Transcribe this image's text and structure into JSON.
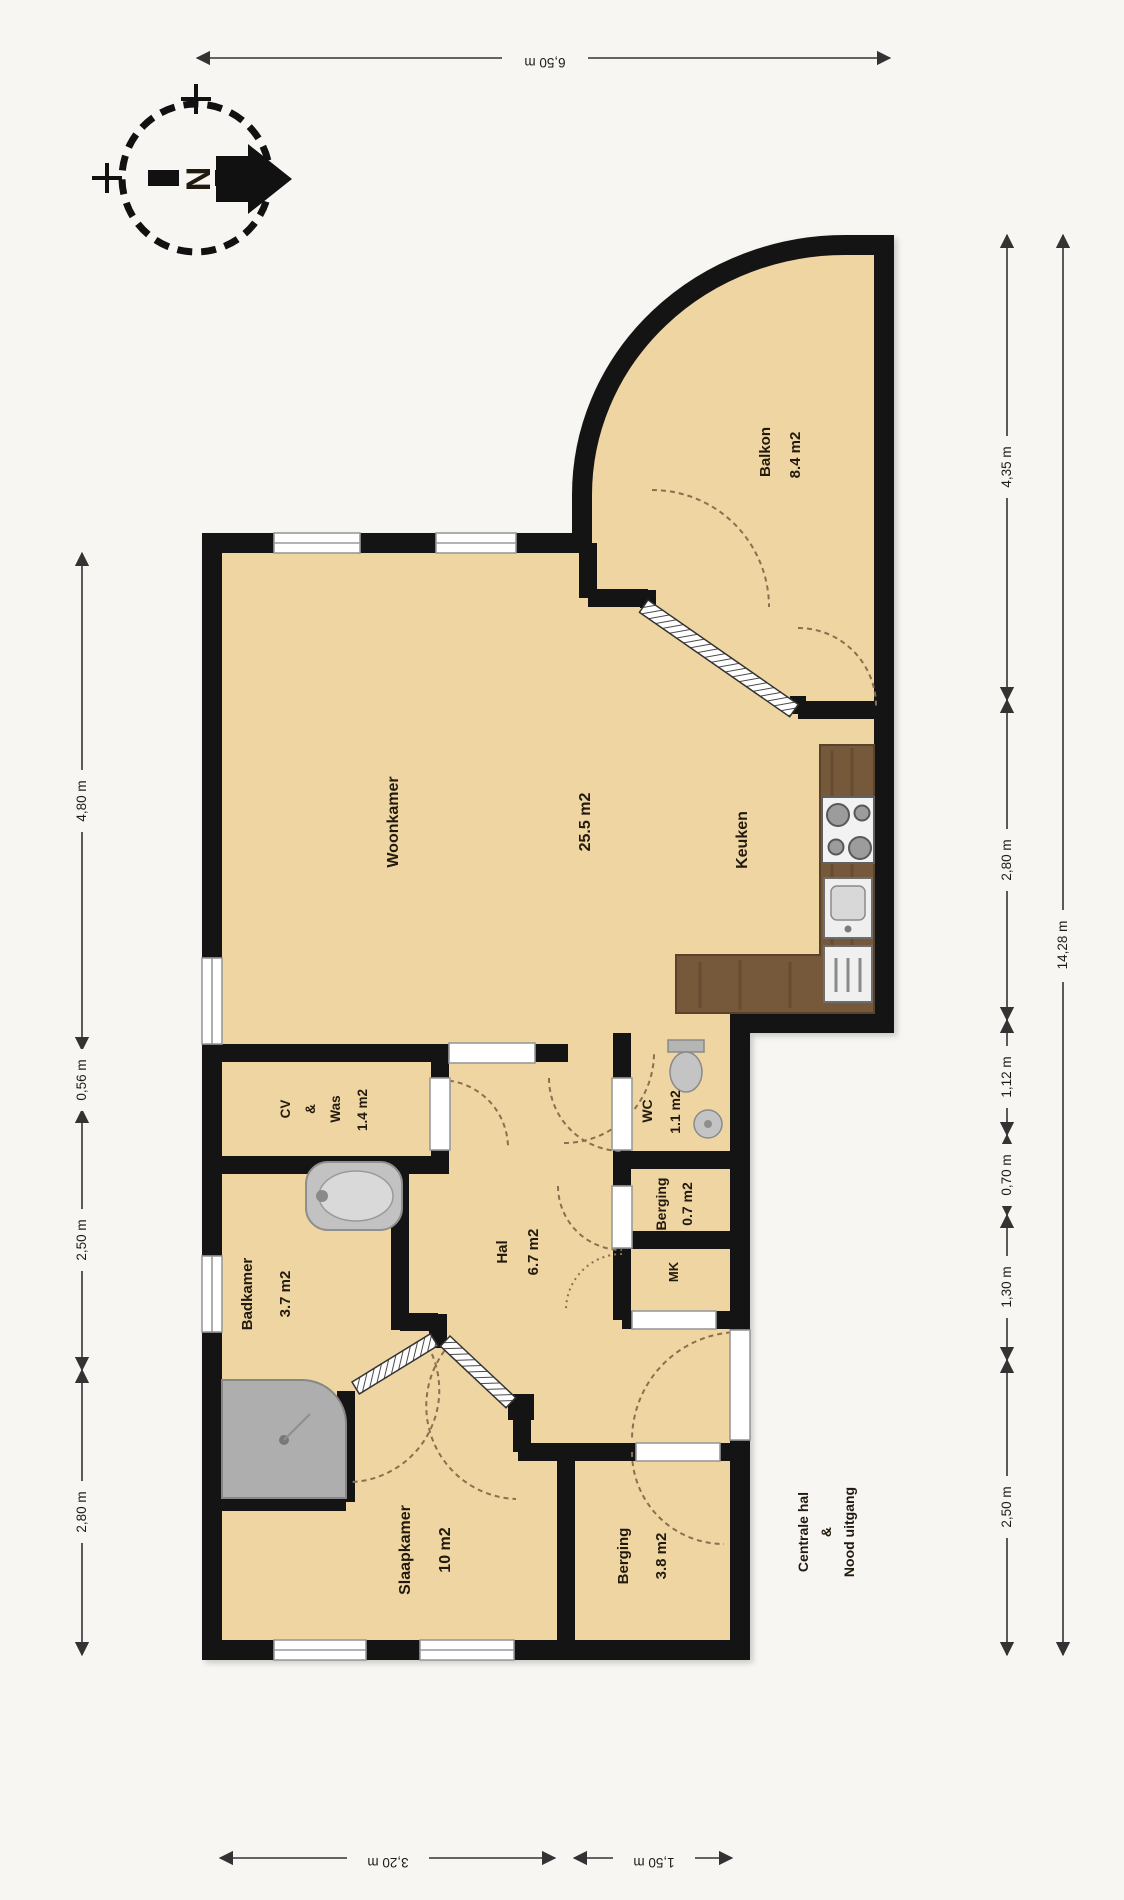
{
  "compass": {
    "north": "N"
  },
  "rooms": {
    "balkon": {
      "name": "Balkon",
      "area": "8.4 m2"
    },
    "woonkamer": {
      "name": "Woonkamer",
      "area": "25.5 m2"
    },
    "keuken": {
      "name": "Keuken"
    },
    "cvwas": {
      "l1": "CV",
      "l2": "&",
      "l3": "Was",
      "area": "1.4 m2"
    },
    "wc": {
      "name": "WC",
      "area": "1.1 m2"
    },
    "badkamer": {
      "name": "Badkamer",
      "area": "3.7 m2"
    },
    "hal": {
      "name": "Hal",
      "area": "6.7 m2"
    },
    "berging_klein": {
      "name": "Berging",
      "area": "0.7 m2"
    },
    "mk": {
      "name": "MK"
    },
    "slaapkamer": {
      "name": "Slaapkamer",
      "area": "10 m2"
    },
    "berging_groot": {
      "name": "Berging",
      "area": "3.8 m2"
    }
  },
  "outside_label": {
    "l1": "Centrale hal",
    "l2": "&",
    "l3": "Nood uitgang"
  },
  "dimensions": {
    "top": "6,50 m",
    "bottom_left": "3,20 m",
    "bottom_right": "1,50 m",
    "left": [
      "4,80 m",
      "0,56 m",
      "2,50 m",
      "2,80 m"
    ],
    "right": [
      "4,35 m",
      "2,80 m",
      "1,12 m",
      "0,70 m",
      "1,30 m",
      "2,50 m"
    ],
    "right_total": "14,28 m"
  },
  "colors": {
    "floor": "#efd5a2",
    "wall": "#141414",
    "counter": "#76593b",
    "fixture_gray": "#bdbdbd",
    "dimension": "#333333"
  }
}
